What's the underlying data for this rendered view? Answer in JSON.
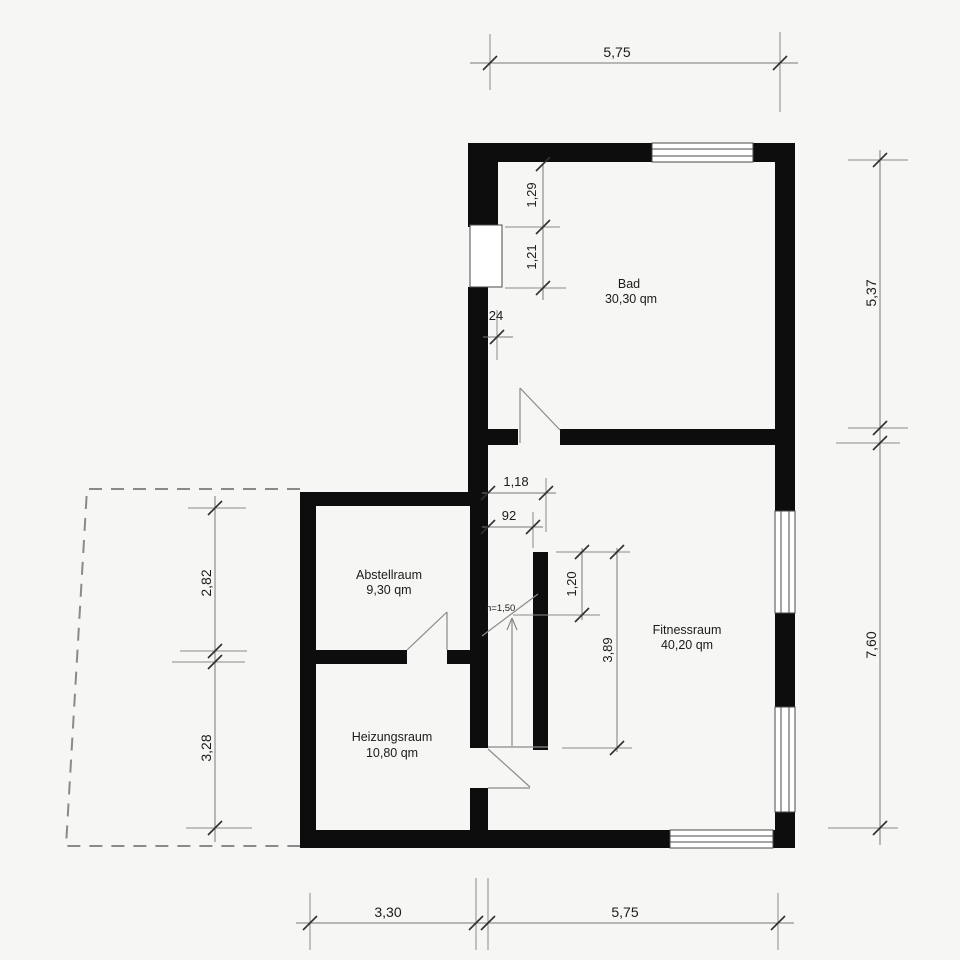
{
  "plan": {
    "title": "floor-plan",
    "rooms": [
      {
        "name": "Bad",
        "area": "30,30 qm"
      },
      {
        "name": "Fitnessraum",
        "area": "40,20 qm"
      },
      {
        "name": "Abstellraum",
        "area": "9,30 qm"
      },
      {
        "name": "Heizungsraum",
        "area": "10,80 qm"
      }
    ],
    "dimensions": {
      "top_width": "5,75",
      "right_upper": "5,37",
      "right_lower": "7,60",
      "left_upper": "2,82",
      "left_lower": "3,28",
      "bottom_left": "3,30",
      "bottom_right": "5,75",
      "bad_wall_seg_upper": "1,29",
      "bad_wall_seg_lower": "1,21",
      "wall_thickness": "24",
      "passage_outer": "1,18",
      "passage_clear": "92",
      "stair_seg": "1,20",
      "stair_length": "3,89",
      "height_line": "h=1,50"
    },
    "colors": {
      "background": "#f6f6f4",
      "wall": "#0d0d0d",
      "thin_line": "#8a8a8a",
      "text": "#1b1b1b"
    }
  }
}
